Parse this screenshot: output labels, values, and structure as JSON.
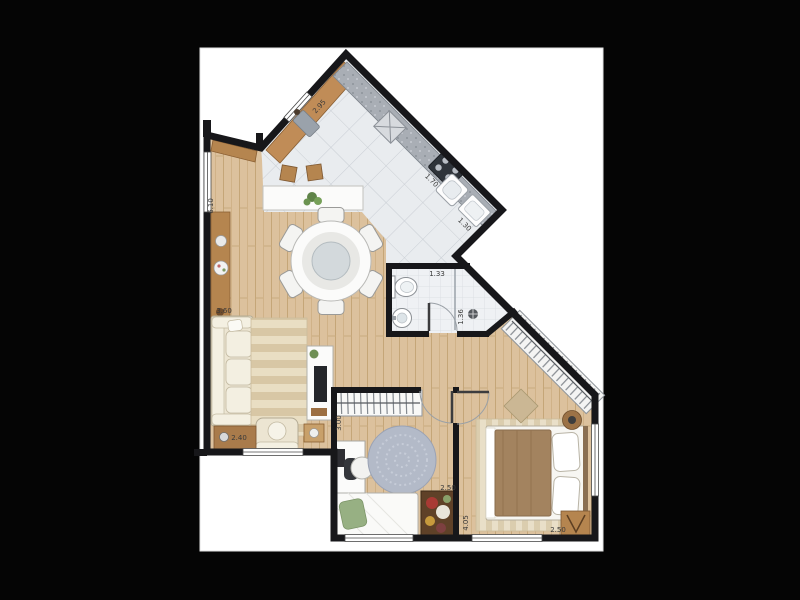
{
  "image": {
    "description": "Apartment floor plan top-view rendering on white page over black background",
    "background": "#050505",
    "paper": "#ffffff"
  },
  "colors": {
    "wall": "#17171a",
    "wood_floor": "#dcc19d",
    "tile_floor": "#e9ecef",
    "bath_floor": "#eff1f4",
    "counter_wood": "#c08c57",
    "counter_granite": "#a9aeb5",
    "furniture_brown": "#b5854f",
    "sofa_cream": "#ece5d2",
    "rug_beige": "#e9dec3",
    "rug_gray": "#b3bac8",
    "duvet_brown": "#a3835f",
    "pillow_green": "#97b083"
  },
  "dimensions": {
    "kitchen_wall_a": "2.95",
    "kitchen_wall_b": "1.70",
    "kitchen_service": "1.30",
    "bathroom_width": "1.33",
    "bathroom_shower": "1.36",
    "living_length": "6.10",
    "living_width": "3.60",
    "living_sideboard": "2.40",
    "bedroom2_length": "3.00",
    "bedroom2_width": "2.50",
    "bedroom1_length": "4.05",
    "bedroom1_width": "2.50"
  }
}
